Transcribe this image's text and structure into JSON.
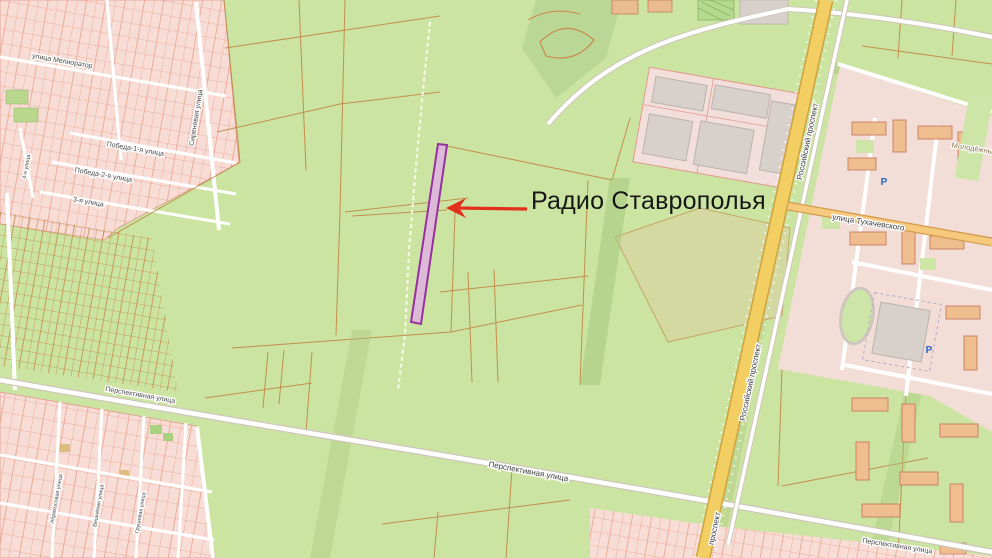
{
  "annotation": {
    "label": "Радио Ставрополья"
  },
  "streets": {
    "meliorator": "улица Мелиоратор",
    "sirenevaya": "Сиреневая улица",
    "pobeda1": "Победа-1-я улица",
    "pobeda2": "Победа-2-я улица",
    "third": "3-я улица",
    "fourth": "4-я улица",
    "perspektivnaya": "Перспективная улица",
    "rossiysky": "Российский проспект",
    "prospekt": "проспект",
    "tukhachevskogo": "улица Тухачевского",
    "abrikosovaya": "Абрикосовая улица",
    "vishnevaya": "Вишнёвая улица",
    "grushevaya": "Грушевая улица"
  },
  "districts": {
    "molodezhny": "Молодёжный"
  },
  "poi": {
    "parking": "P"
  },
  "colors": {
    "arrow": "#e2301c",
    "highlight_fill": "#dcb9d6",
    "highlight_stroke": "#982f9e",
    "primary_road": "#f2ce63",
    "map_green": "#cce4a1",
    "parcel_line": "#c08040",
    "allotment_pink": "#f7ddd6"
  }
}
